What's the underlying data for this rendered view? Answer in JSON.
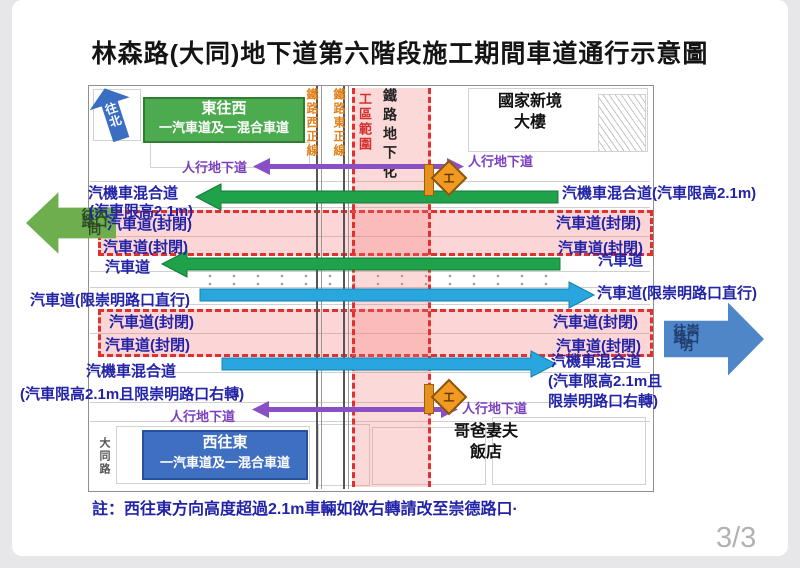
{
  "title": "林森路(大同)地下道第六階段施工期間車道通行示意圖",
  "note": "註：西往東方向高度超過2.1m車輛如欲右轉請改至崇德路口·",
  "page": {
    "indicator": "3/3"
  },
  "compass": {
    "north": "往北"
  },
  "direction_boxes": {
    "east_to_west": {
      "dir": "東往西",
      "lanes": "一汽車道及一混合車道"
    },
    "west_to_east": {
      "dir": "西往東",
      "lanes": "一汽車道及一混合車道"
    }
  },
  "side_arrows": {
    "datong": {
      "l1": "往大同",
      "l2": "路口"
    },
    "chongming": {
      "l1": "往崇明",
      "l2": "路口"
    }
  },
  "railway": {
    "west_main": "鐵路西正線",
    "east_main": "鐵路東正線",
    "work_zone": "工區範圍",
    "underground": "鐵路地下化",
    "work_sign": "工"
  },
  "pedestrian": {
    "nw": "人行地下道",
    "ne": "人行地下道",
    "sw": "人行地下道",
    "se": "人行地下道"
  },
  "places": {
    "national_building_1": "國家新境",
    "national_building_2": "大樓",
    "hotel_1": "哥爸妻夫",
    "hotel_2": "飯店",
    "datong_road": "大同路"
  },
  "lanes": {
    "left": [
      "汽機車混合道",
      "(汽車限高2.1m)",
      "汽車道(封閉)",
      "汽車道(封閉)",
      "汽車道",
      "汽車道(限崇明路口直行)",
      "汽車道(封閉)",
      "汽車道(封閉)",
      "汽機車混合道",
      "(汽車限高2.1m且限崇明路口右轉)"
    ],
    "right": [
      "汽機車混合道(汽車限高2.1m)",
      "汽車道(封閉)",
      "汽車道(封閉)",
      "汽車道",
      "汽車道(限崇明路口直行)",
      "汽車道(封閉)",
      "汽車道(封閉)",
      "汽機車混合道",
      "(汽車限高2.1m且",
      "限崇明路口右轉)"
    ]
  },
  "colors": {
    "closed_red": "#e03131",
    "pink_fill": "#f8d3d3",
    "lane_green": "#1fa24a",
    "lane_blue": "#29a6de",
    "ped_purple": "#8a4fc4",
    "label_navy": "#2323a8",
    "rail_orange": "#e0821c"
  }
}
